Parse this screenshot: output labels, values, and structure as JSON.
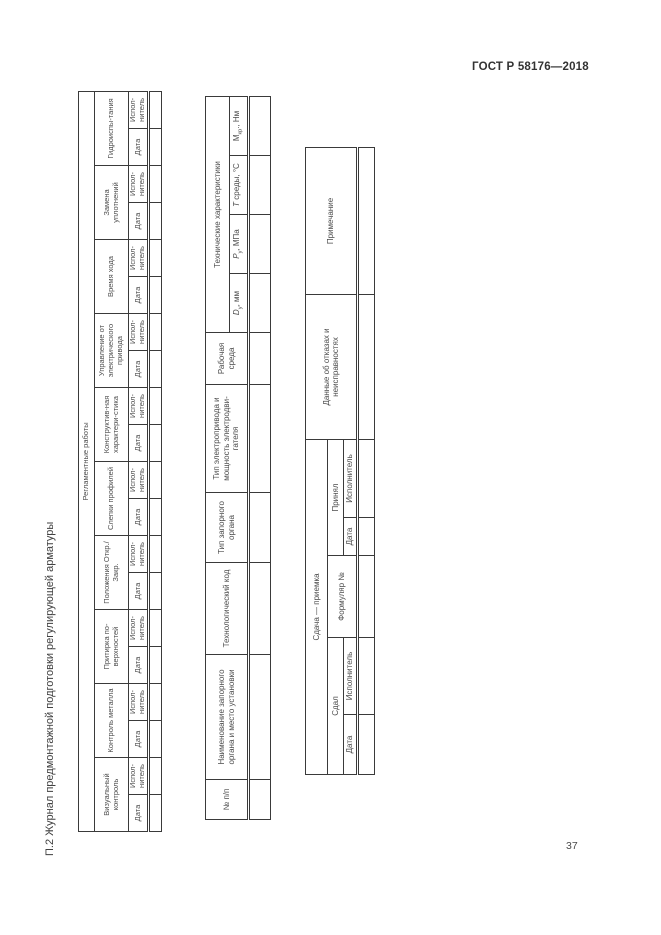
{
  "page": {
    "doc_code": "ГОСТ Р 58176—2018",
    "page_number": "37",
    "vertical_title": "П.2 Журнал предмонтажной подготовки регулирующей арматуры"
  },
  "regulated_works_table": {
    "title": "Регламентные работы",
    "col_date": "Дата",
    "col_executor": "Испол-нитель",
    "groups": [
      "Визуальный контроль",
      "Контроль металла",
      "Притирка по-верхностей",
      "Положения Откр./Закр.",
      "Слепки профилей",
      "Конструктив-ная характери-стика",
      "Управление от электрического привода",
      "Время хода",
      "Замена уплотнений",
      "Гидроиспы-тания"
    ]
  },
  "equipment_table": {
    "col_num": "№ п/п",
    "col_name": "Наименование запорного органа и место установки",
    "col_tech_code": "Технологический код",
    "col_valve_type": "Тип запорного органа",
    "col_drive": "Тип электропривода и мощность электродви-гателя",
    "col_medium": "Рабочая среда",
    "tech_group": "Технические характеристики",
    "tech_cols": [
      {
        "base": "D",
        "sub": "у",
        "rest": ", мм"
      },
      {
        "base": "P",
        "sub": "у",
        "rest": ", МПа"
      },
      {
        "base": "Т",
        "sub": "",
        "rest": " среды, °С"
      },
      {
        "base": "М",
        "sub": "кр",
        "rest": "., Нм"
      }
    ]
  },
  "acceptance_table": {
    "title": "Сдача — приемка",
    "group_handed": "Сдал",
    "group_received": "Принял",
    "col_date": "Дата",
    "col_executor": "Исполнитель",
    "col_form": "Формуляр №",
    "col_failures": "Данные об отказах и неисправностях",
    "col_notes": "Примечание"
  }
}
